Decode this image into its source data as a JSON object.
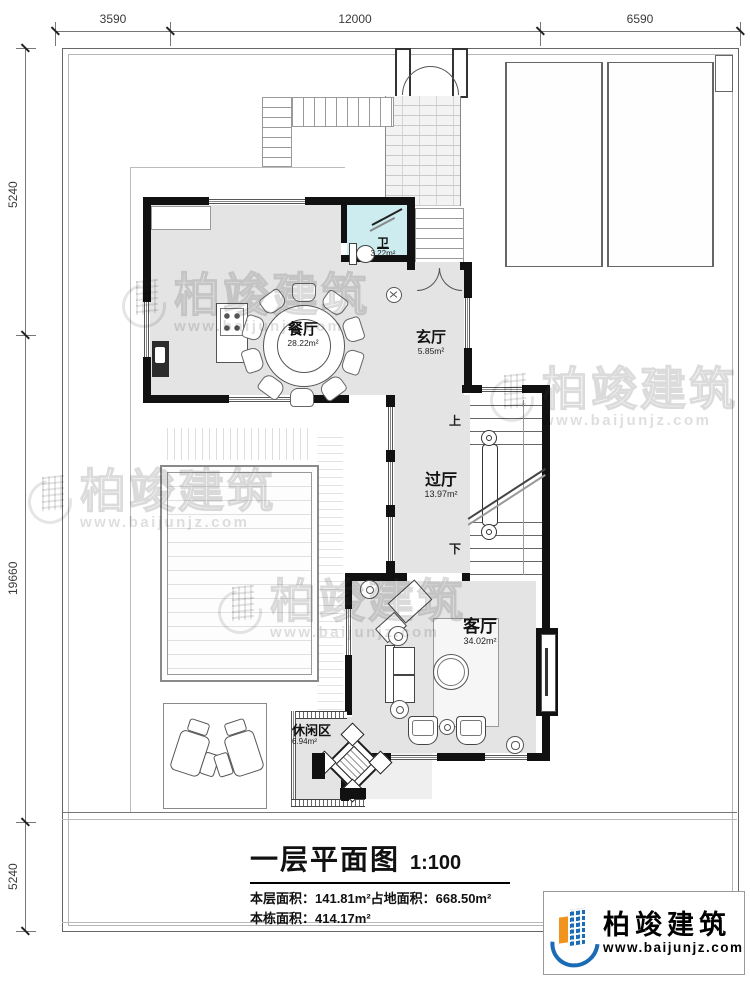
{
  "dimensions": {
    "top": [
      "3590",
      "12000",
      "6590"
    ],
    "left": [
      "5240",
      "19660",
      "5240"
    ]
  },
  "rooms": {
    "dining": {
      "name": "餐厅",
      "area": "28.22m²"
    },
    "entry": {
      "name": "玄厅",
      "area": "5.85m²"
    },
    "bath": {
      "name": "卫",
      "area": "3.22m²"
    },
    "hall": {
      "name": "过厅",
      "area": "13.97m²"
    },
    "living": {
      "name": "客厅",
      "area": "34.02m²"
    },
    "leisure": {
      "name": "休闲区",
      "area": "6.94m²"
    }
  },
  "stairs": {
    "up_label": "上",
    "down_label": "下"
  },
  "title_block": {
    "title": "一层平面图",
    "scale": "1:100",
    "area_line1_a": "本层面积：141.81m²",
    "area_line1_b": "占地面积：668.50m²",
    "area_line2": "本栋面积：414.17m²"
  },
  "branding": {
    "company": "柏竣建筑",
    "website": "www.baijunjz.com"
  },
  "watermark": {
    "company": "柏竣建筑",
    "website": "www.baijunjz.com"
  },
  "colors": {
    "wall": "#111111",
    "floor": "#e4e4e4",
    "bath_floor": "#cdecef",
    "line": "#555555",
    "logo_blue": "#1b6cb5",
    "logo_orange": "#f0941d"
  }
}
